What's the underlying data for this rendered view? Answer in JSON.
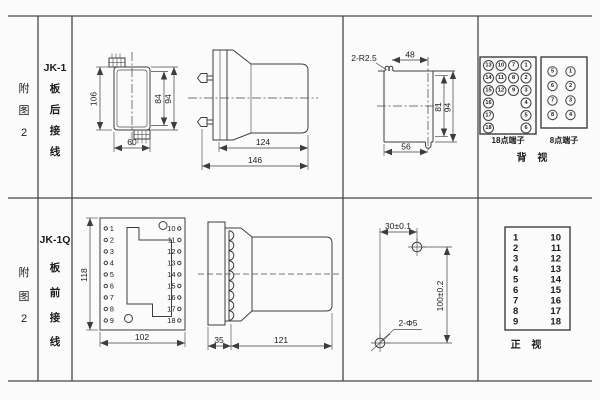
{
  "row1": {
    "fig": [
      "附",
      "图",
      "2"
    ],
    "model": "JK-1",
    "wiring": [
      "板",
      "后",
      "接",
      "线"
    ],
    "back_view": {
      "height": "106",
      "width": "60",
      "inner_height": "84",
      "outer_height": "94"
    },
    "side_view": {
      "body_length": "124",
      "total_length": "146"
    },
    "cutout": {
      "slot_note": "2-R2.5",
      "top_width": "48",
      "inner_height": "81",
      "outer_height": "94",
      "bottom_width": "56"
    },
    "t18": {
      "label": "18点端子",
      "c1": [
        "13",
        "14",
        "15",
        "16",
        "17",
        "18"
      ],
      "c2": [
        "10",
        "11",
        "12"
      ],
      "c3": [
        "7",
        "8",
        "9"
      ],
      "c4": [
        "1",
        "2",
        "3",
        "4",
        "5",
        "6"
      ]
    },
    "t8": {
      "label": "8点端子",
      "c1": [
        "5",
        "6",
        "7",
        "8"
      ],
      "c2": [
        "1",
        "2",
        "3",
        "4"
      ]
    },
    "view_label": "背 视"
  },
  "row2": {
    "fig": [
      "附",
      "图",
      "2"
    ],
    "model": "JK-1Q",
    "wiring": [
      "板",
      "前",
      "接",
      "线"
    ],
    "front_plate": {
      "height": "118",
      "width": "102",
      "left": [
        "1",
        "2",
        "3",
        "4",
        "5",
        "6",
        "7",
        "8",
        "9"
      ],
      "right": [
        "10",
        "11",
        "12",
        "13",
        "14",
        "15",
        "16",
        "17",
        "18"
      ]
    },
    "side_view": {
      "plate_depth": "35",
      "body_length": "121"
    },
    "drill": {
      "spacing_x": "30±0.1",
      "spacing_y": "100±0.2",
      "note": "2-Φ5"
    },
    "front_view": {
      "left": [
        "1",
        "2",
        "3",
        "4",
        "5",
        "6",
        "7",
        "8",
        "9"
      ],
      "right": [
        "10",
        "11",
        "12",
        "13",
        "14",
        "15",
        "16",
        "17",
        "18"
      ],
      "label": "正 视"
    }
  }
}
